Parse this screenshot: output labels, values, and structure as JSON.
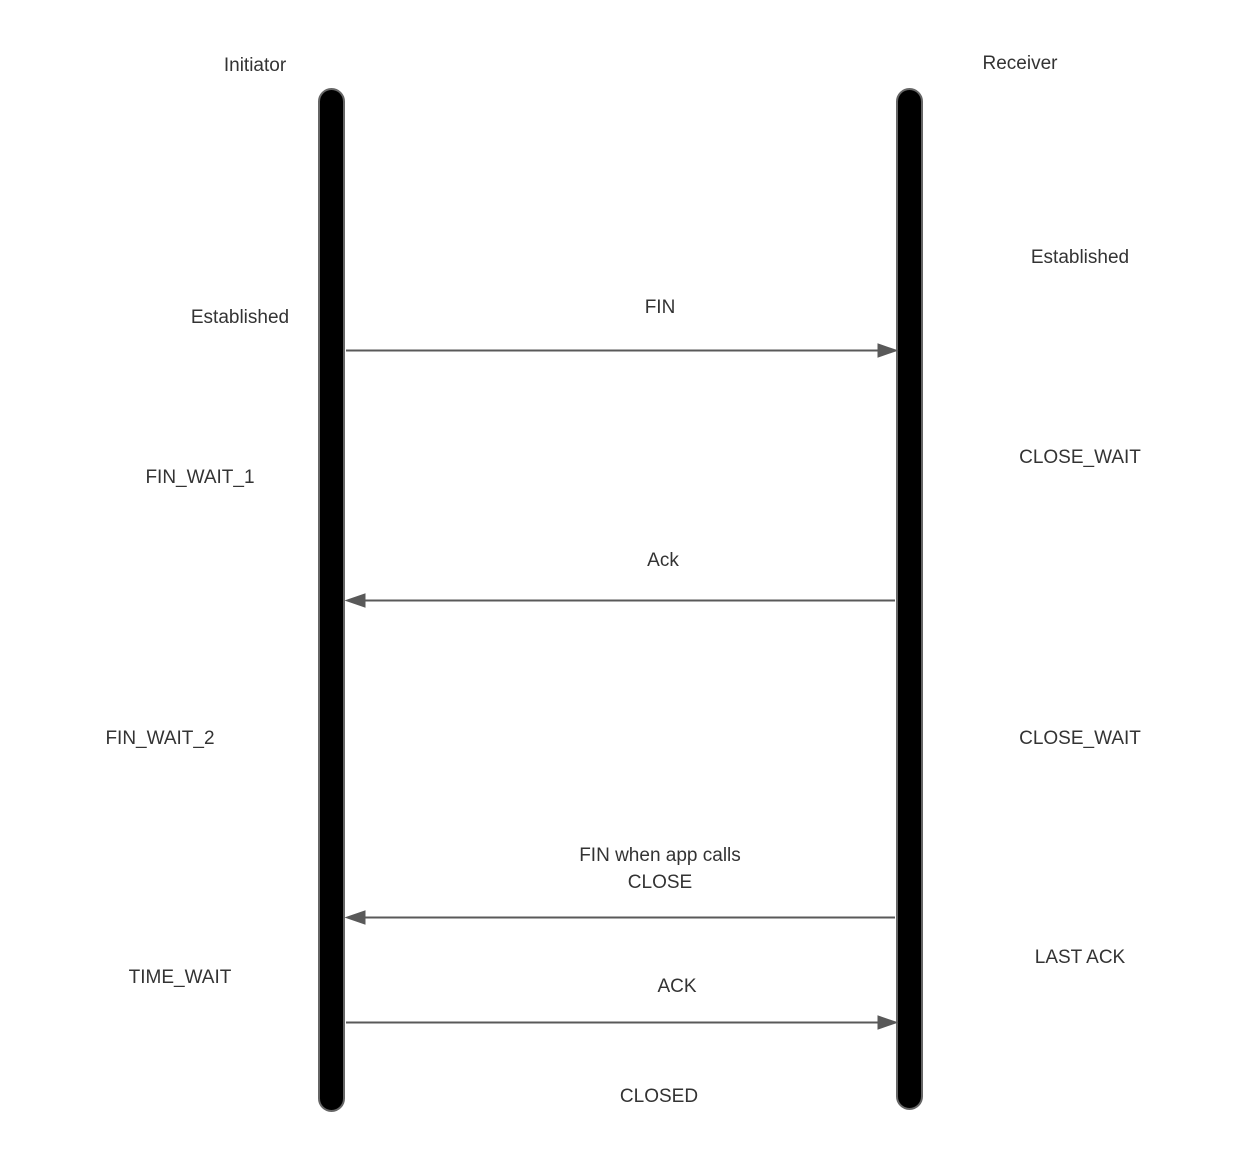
{
  "diagram": {
    "type": "sequence",
    "subject": "TCP connection termination handshake",
    "actors": [
      {
        "name": "Initiator"
      },
      {
        "name": "Receiver"
      }
    ],
    "initiator_states": [
      {
        "label": "Established"
      },
      {
        "label": "FIN_WAIT_1"
      },
      {
        "label": "FIN_WAIT_2"
      },
      {
        "label": "TIME_WAIT"
      }
    ],
    "receiver_states": [
      {
        "label": "Established"
      },
      {
        "label": "CLOSE_WAIT"
      },
      {
        "label": "CLOSE_WAIT"
      },
      {
        "label": "LAST ACK"
      }
    ],
    "messages": [
      {
        "label": "FIN",
        "from": "Initiator",
        "to": "Receiver",
        "direction": "right"
      },
      {
        "label": "Ack",
        "from": "Receiver",
        "to": "Initiator",
        "direction": "left"
      },
      {
        "label": "FIN when app calls CLOSE",
        "from": "Receiver",
        "to": "Initiator",
        "direction": "left"
      },
      {
        "label": "ACK",
        "from": "Initiator",
        "to": "Receiver",
        "direction": "right"
      }
    ],
    "final_state": "CLOSED",
    "colors": {
      "background": "#ffffff",
      "lifeline_fill": "#000000",
      "lifeline_border": "#666666",
      "arrow": "#595959",
      "text": "#333333"
    }
  }
}
